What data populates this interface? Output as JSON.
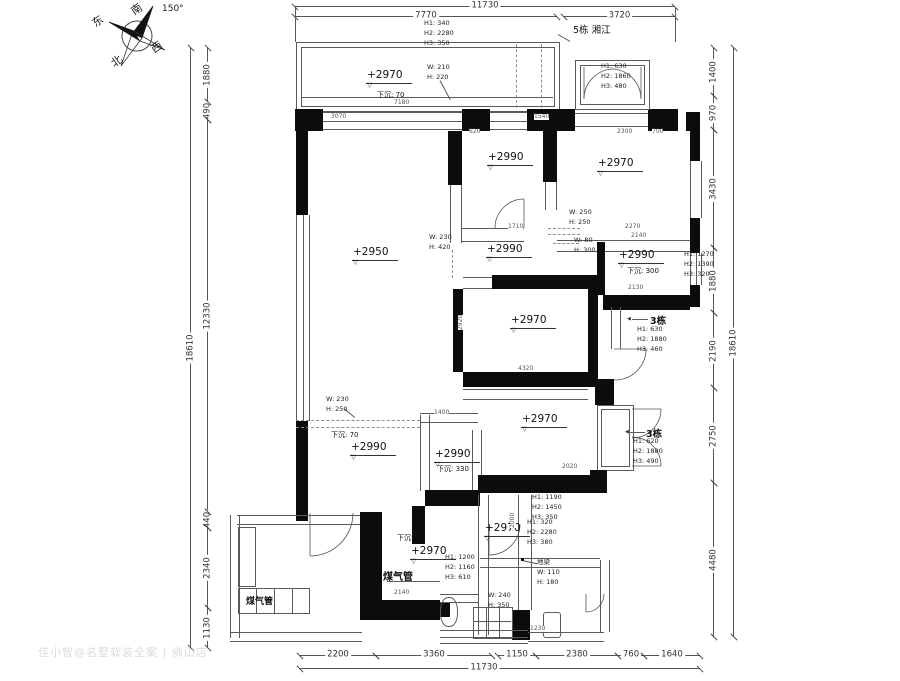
{
  "compass": {
    "south": "南",
    "east": "东",
    "west": "西",
    "north": "北",
    "angle": "150°"
  },
  "dims": {
    "top": {
      "overall": "11730",
      "segments": [
        "7770",
        "3720"
      ]
    },
    "bottom": {
      "overall": "11730",
      "segments": [
        "2200",
        "3360",
        "1150",
        "2380",
        "760",
        "1640"
      ]
    },
    "left": {
      "overall": "18610",
      "segments": [
        "1880",
        "490",
        "12330",
        "440",
        "2340",
        "1130"
      ]
    },
    "right": {
      "overall": "18610",
      "segments": [
        "1400",
        "970",
        "3430",
        "1880",
        "2190",
        "2750",
        "4480"
      ]
    }
  },
  "buildings": {
    "b5": "5栋 湘江",
    "b3a": "3栋",
    "b3b": "3栋"
  },
  "rooms": {
    "balcony": {
      "level": "+2970",
      "sunken": "下沉: 70"
    },
    "bed1": {
      "level": "+2990"
    },
    "bed2": {
      "level": "+2970"
    },
    "living": {
      "level": "+2950"
    },
    "corridor": {
      "level": "+2990"
    },
    "bath1": {
      "level": "+2990",
      "sunken": "下沉: 300"
    },
    "bed3": {
      "level": "+2970"
    },
    "lower_left": {
      "level": "+2990",
      "sunken": "下沉: 70"
    },
    "lower_mid": {
      "level": "+2990",
      "sunken": "下沉: 330"
    },
    "bed4": {
      "level": "+2970"
    },
    "hall": {
      "level": "+2970",
      "sunken": "下沉: 60"
    },
    "bath2": {
      "level": "+2970"
    }
  },
  "ann": {
    "top_h": [
      "H1: 340",
      "H2: 2280",
      "H3: 350"
    ],
    "bay_tr": [
      "H1: 630",
      "H2: 1860",
      "H3: 480"
    ],
    "right_mid": [
      "H1: 1270",
      "H2: 1390",
      "H3: 320"
    ],
    "b3a_h": [
      "H1: 630",
      "H2: 1880",
      "H3: 460"
    ],
    "b3b_h": [
      "H1: 620",
      "H2: 1880",
      "H3: 490"
    ],
    "br1": [
      "H1: 1190",
      "H2: 1450",
      "H3: 350"
    ],
    "br2": [
      "H1: 320",
      "H2: 2280",
      "H3: 380"
    ],
    "bottom_h": [
      "H1: 1200",
      "H2: 1160",
      "H3: 610"
    ],
    "beam_top": [
      "W: 210",
      "H: 220"
    ],
    "beam_left": [
      "W: 230",
      "H: 420"
    ],
    "beam_c1": [
      "W: 250",
      "H: 250"
    ],
    "beam_c2": [
      "W: 80",
      "H: 300"
    ],
    "beam_ll": [
      "W: 230",
      "H: 250"
    ],
    "ground_beam": [
      "地梁",
      "W: 110",
      "H: 180"
    ],
    "beam_b": [
      "W: 240",
      "H: 350"
    ],
    "gas1": "煤气管",
    "gas2": "煤气管"
  },
  "icons": {
    "arrow_left": "◀"
  },
  "minor_dims": [
    "7180",
    "3070",
    "1540",
    "2300",
    "700",
    "1710",
    "2270",
    "2140",
    "4320",
    "2130",
    "2020",
    "1400",
    "2140",
    "1230",
    "2920",
    "2000",
    "620"
  ],
  "watermark": "佳小智@名墅软装全案 | 佛山店"
}
